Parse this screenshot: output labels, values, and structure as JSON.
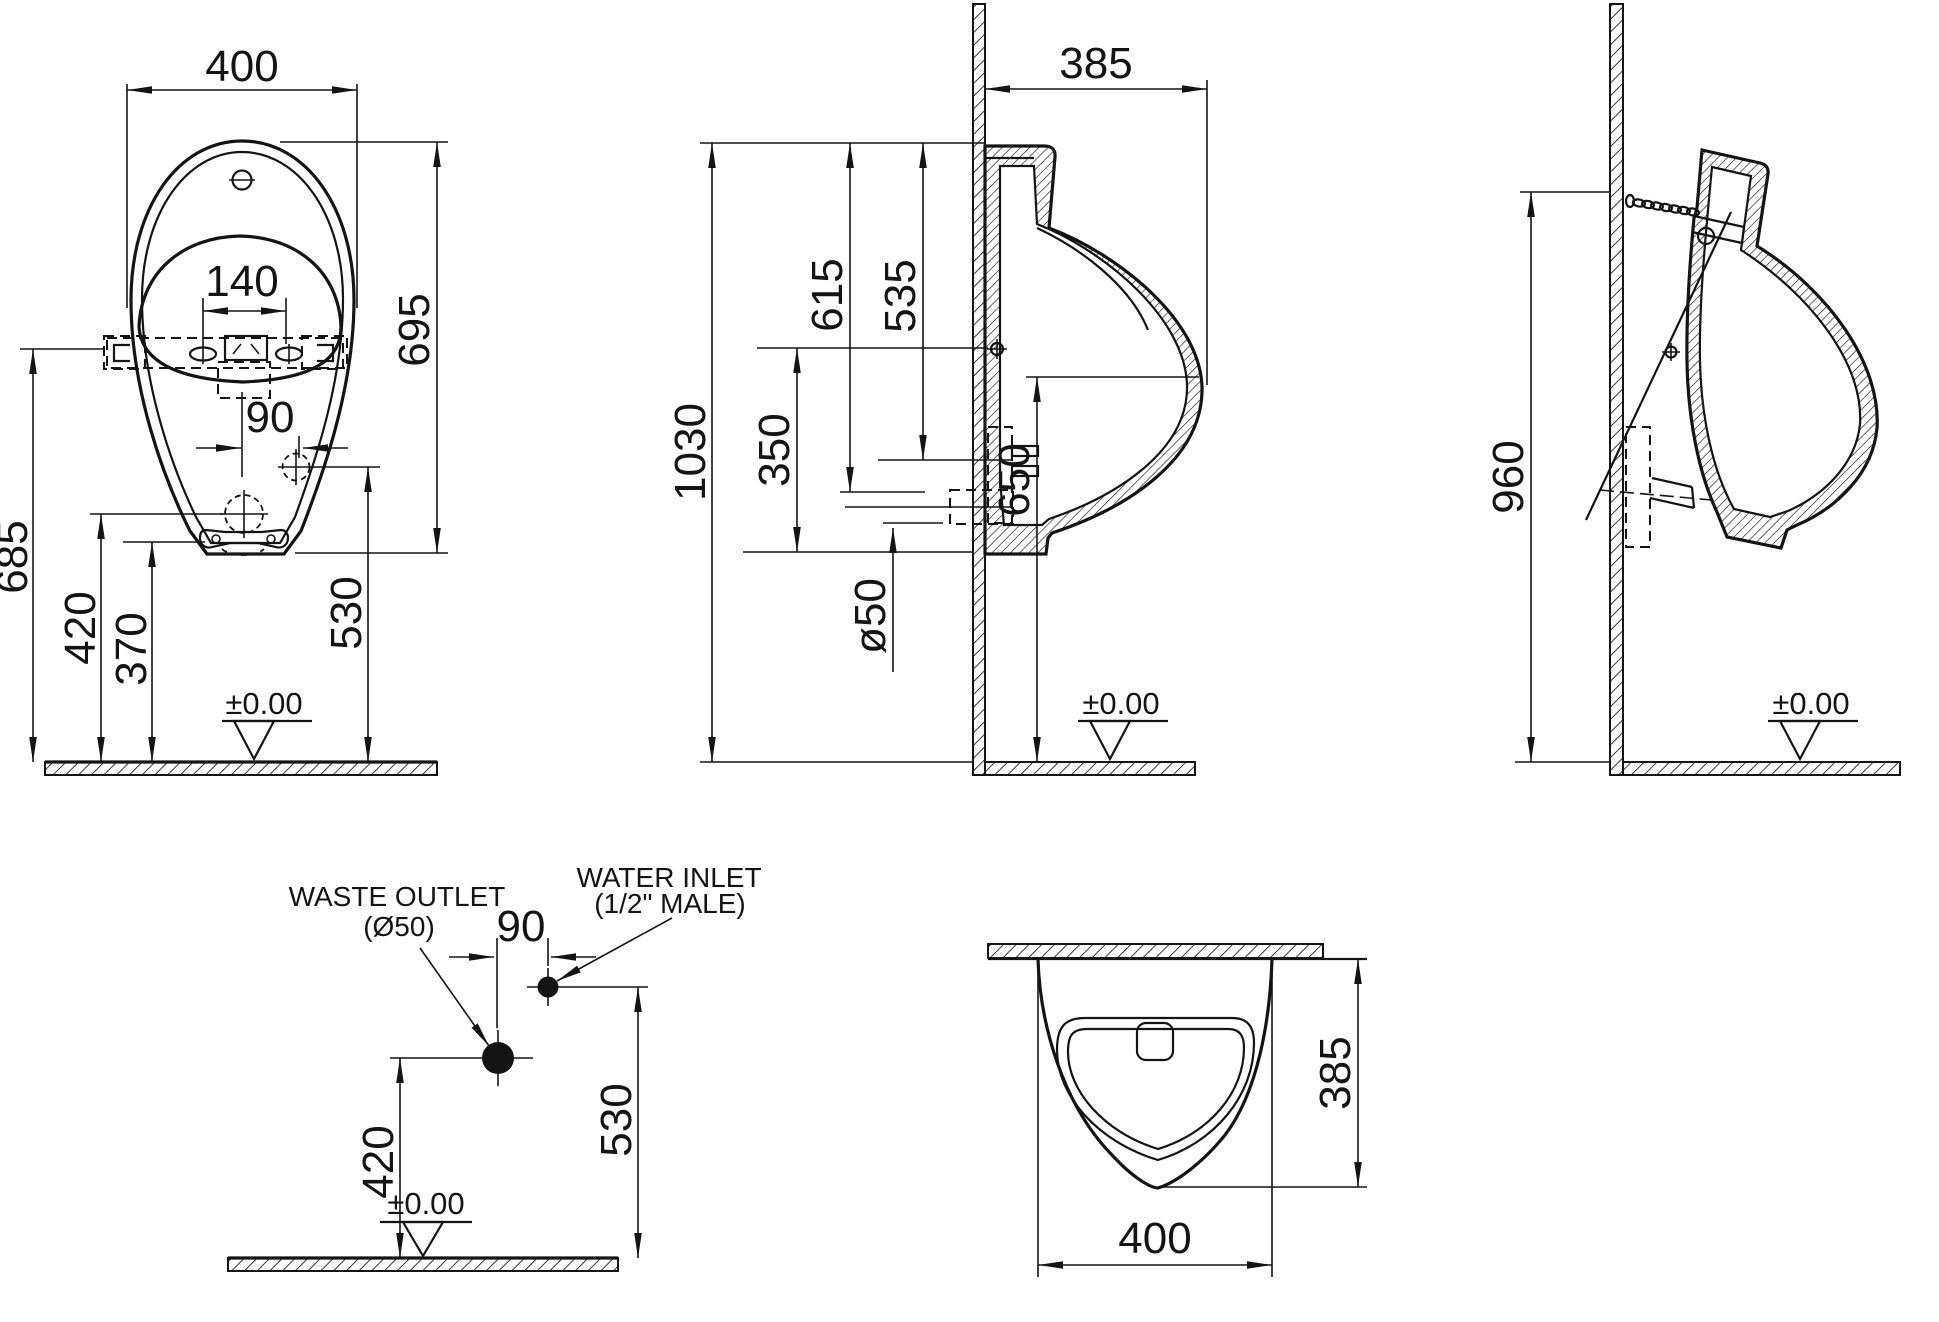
{
  "front": {
    "width": "400",
    "spreader_span": "140",
    "inlet_offset": "90",
    "body_height": "695",
    "hanger_height": "685",
    "outlet_height": "420",
    "bracket_height": "370",
    "inlet_height": "530",
    "datum": "±0.00"
  },
  "side": {
    "depth": "385",
    "total_height": "1030",
    "top_to_outlet": "615",
    "top_to_inlet": "535",
    "fixing_to_spout": "350",
    "outlet_diameter": "ø50",
    "rim_height": "650",
    "datum": "±0.00"
  },
  "chain": {
    "anchor_height": "960",
    "datum": "±0.00"
  },
  "connections": {
    "waste_line1": "WASTE OUTLET",
    "waste_line2": "(Ø50)",
    "inlet_line1": "WATER INLET",
    "inlet_line2": "(1/2\" MALE)",
    "offset": "90",
    "outlet_height": "420",
    "inlet_height": "530",
    "datum": "±0.00"
  },
  "plan": {
    "depth": "385",
    "width": "400"
  }
}
